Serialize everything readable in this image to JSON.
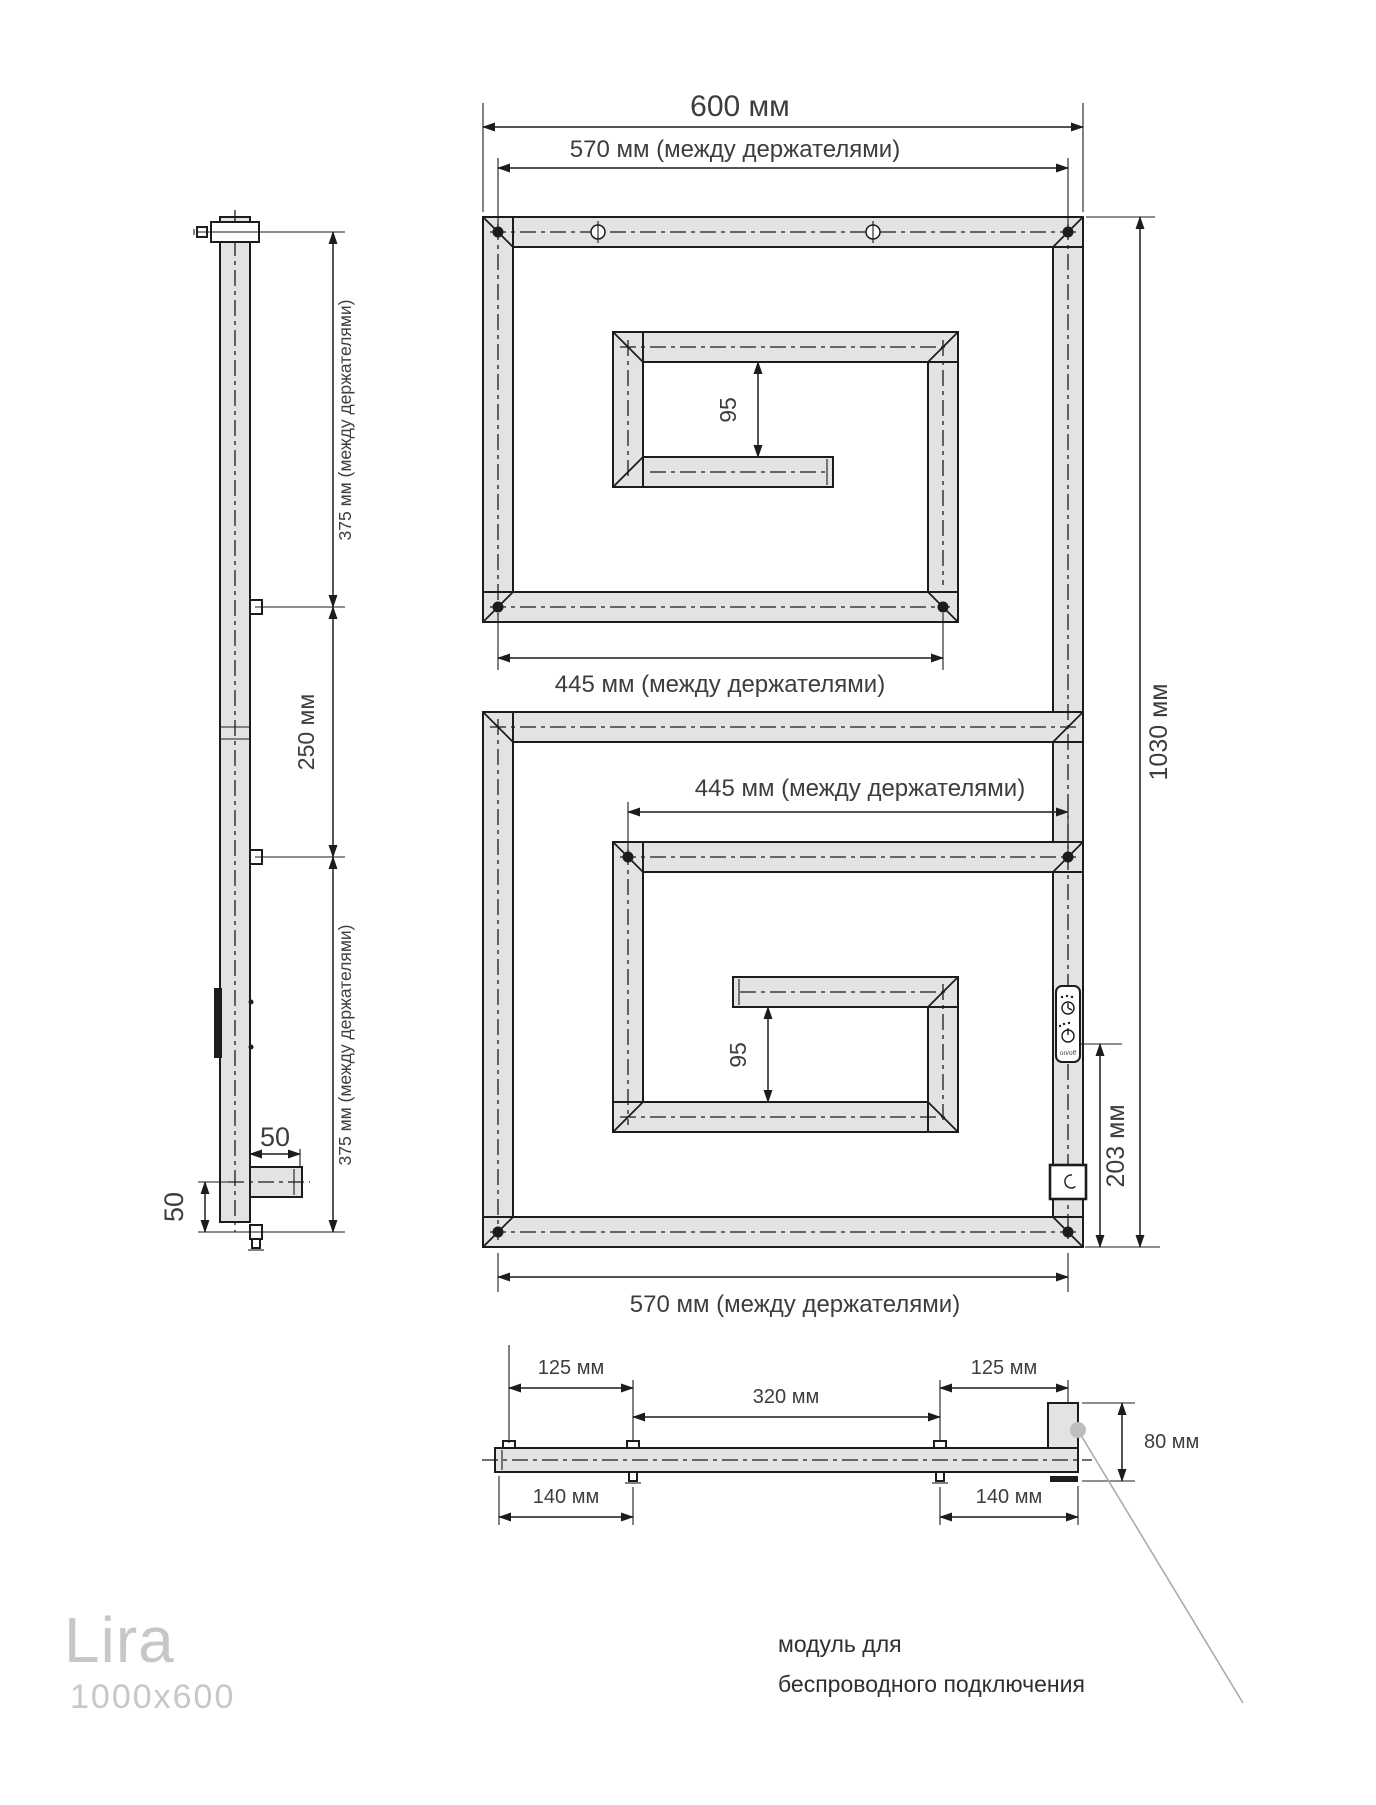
{
  "product": {
    "model": "Lira",
    "dimensions": "1000x600"
  },
  "front_view": {
    "width_label": "600 мм",
    "width_between_holders_label": "570 мм (между держателями)",
    "upper_holders_label": "445 мм (между держателями)",
    "lower_holders_label": "445 мм (между держателями)",
    "upper_gap_label": "95",
    "lower_gap_label": "95",
    "height_label": "1030 мм",
    "module_offset_label": "203 мм",
    "bottom_holders_label": "570 мм (между держателями)",
    "module_switch_label": "on/off"
  },
  "side_view": {
    "upper_span_label": "375 мм (между держателями)",
    "middle_span_label": "250 мм",
    "lower_span_label": "375 мм (между держателями)",
    "outlet_width_label": "50",
    "outlet_height_label": "50"
  },
  "top_view": {
    "left_inset_label": "125 мм",
    "center_span_label": "320 мм",
    "right_inset_label": "125 мм",
    "left_bracket_label": "140 мм",
    "right_bracket_label": "140 мм",
    "depth_label": "80 мм"
  },
  "annotation": {
    "line1": "модуль для",
    "line2": "беспроводного подключения"
  },
  "colors": {
    "ink": "#1c1c1c",
    "tube_fill": "#e3e3e3",
    "dim_text": "#3d3d3d",
    "logo": "#c7c7c7",
    "leader": "#ababab",
    "leader_dot": "#bdbdbd",
    "background": "#ffffff"
  }
}
